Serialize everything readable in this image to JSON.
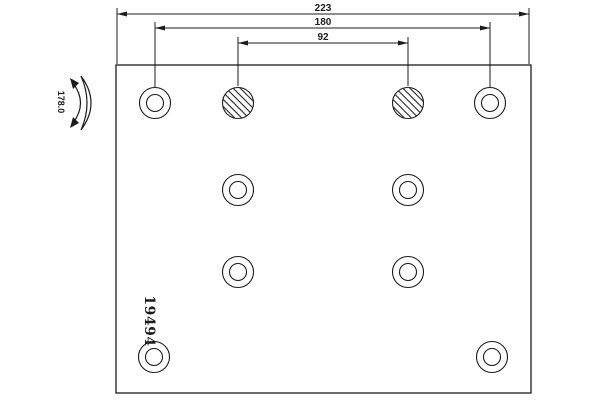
{
  "drawing": {
    "part_number": "19494",
    "curvature_value": "178.0",
    "dim_total": "223",
    "dim_outer": "180",
    "dim_inner": "92"
  },
  "holes": {
    "ring_outer_r": 15.5,
    "ring_inner_r": 8.5,
    "hatched_r": 15.5,
    "ring": [
      {
        "cx": 155,
        "cy": 103
      },
      {
        "cx": 490,
        "cy": 103
      },
      {
        "cx": 238,
        "cy": 190
      },
      {
        "cx": 408,
        "cy": 190
      },
      {
        "cx": 238,
        "cy": 272
      },
      {
        "cx": 408,
        "cy": 272
      },
      {
        "cx": 154,
        "cy": 357
      },
      {
        "cx": 492,
        "cy": 357
      }
    ],
    "hatched": [
      {
        "cx": 238,
        "cy": 103
      },
      {
        "cx": 408,
        "cy": 103
      }
    ]
  },
  "colors": {
    "line": "#1c1c1c",
    "background": "#ffffff"
  }
}
